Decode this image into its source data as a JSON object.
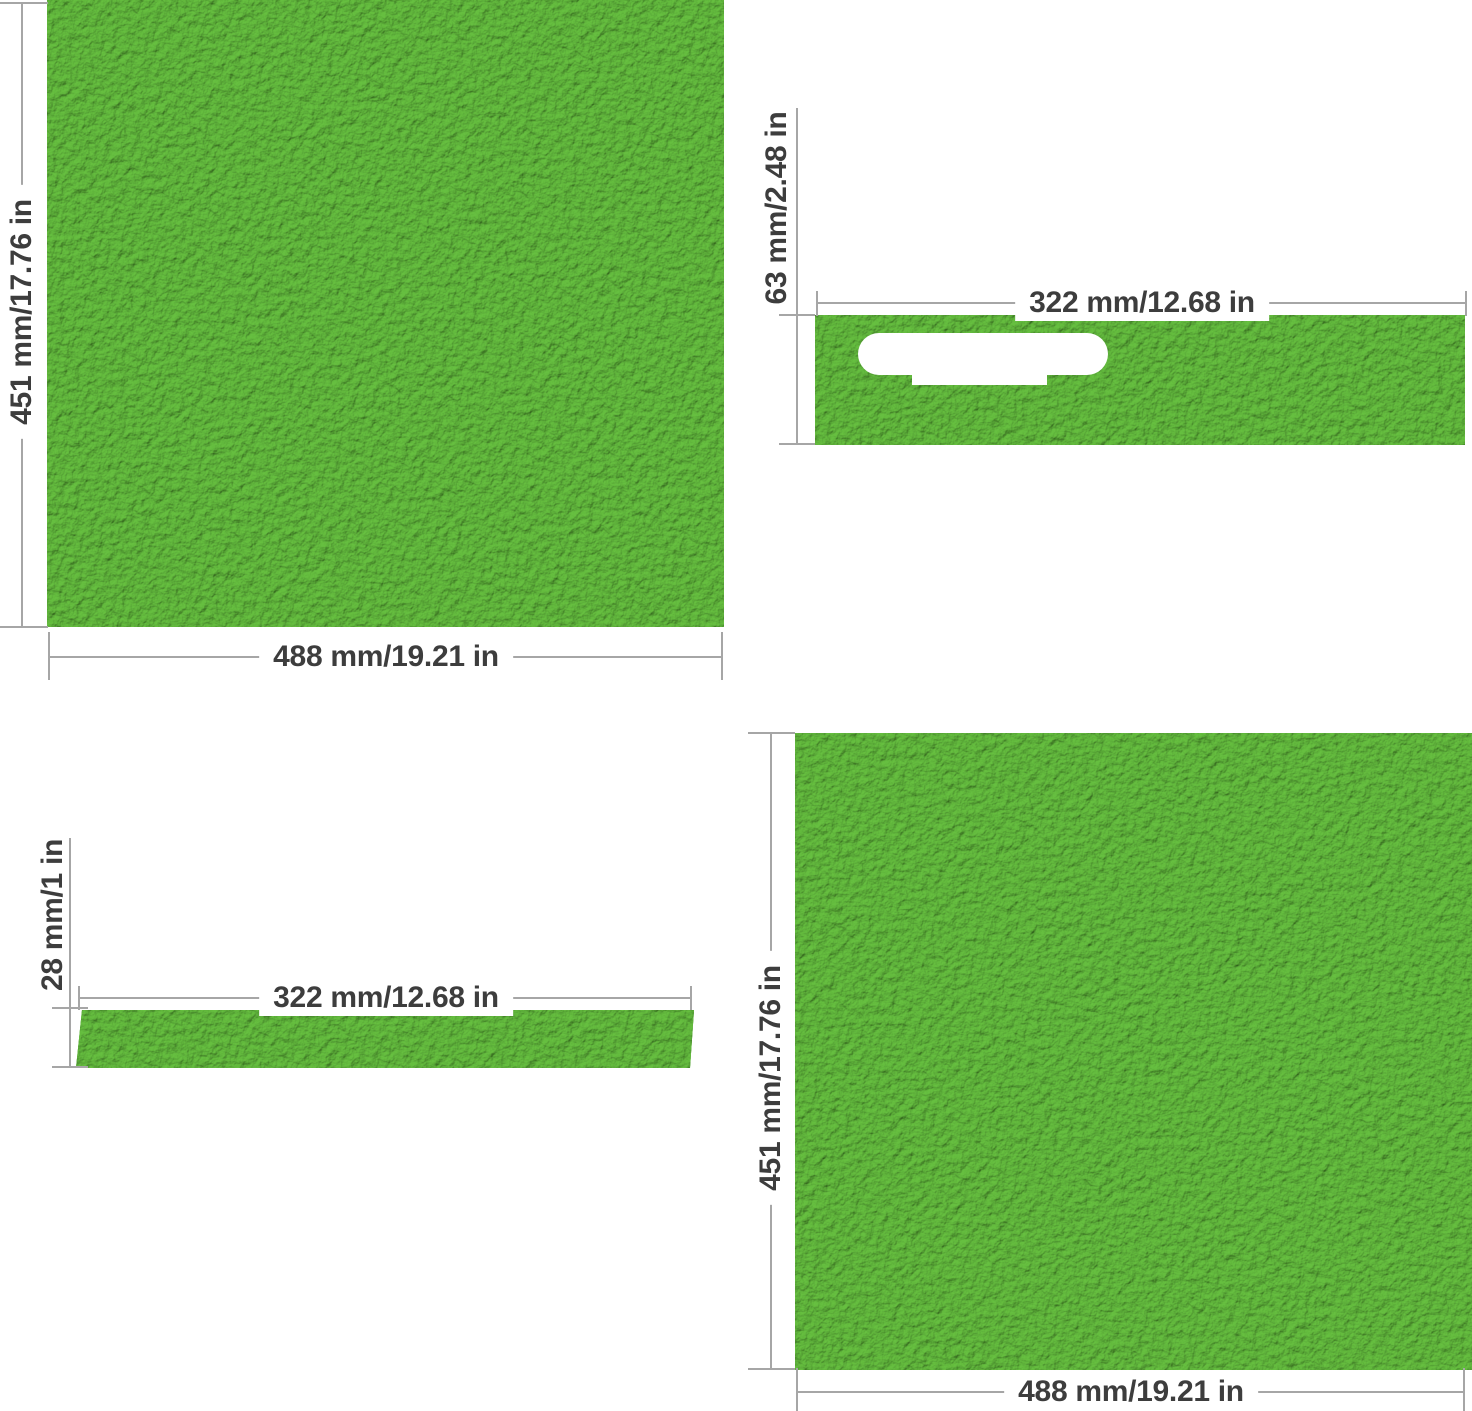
{
  "colors": {
    "background": "#ffffff",
    "leather_green": "#58a938",
    "leather_highlight": "#66c041",
    "leather_shadow": "#4a9a2c",
    "dimension_line": "#a6a6a6",
    "label_text": "#3d3d3d",
    "handle_cutout": "#ffffff"
  },
  "panels": [
    {
      "name": "large-square-panel-top-left",
      "width_label": "488 mm/19.21 in",
      "height_label": "451 mm/17.76 in"
    },
    {
      "name": "handle-strip-panel-top-right",
      "width_label": "322 mm/12.68 in",
      "height_label": "63 mm/2.48 in",
      "cutout": "handle-slot"
    },
    {
      "name": "thin-strip-panel-bottom-left",
      "width_label": "322 mm/12.68 in",
      "height_label": "28 mm/1 in"
    },
    {
      "name": "large-square-panel-bottom-right",
      "width_label": "488 mm/19.21 in",
      "height_label": "451 mm/17.76 in"
    }
  ]
}
